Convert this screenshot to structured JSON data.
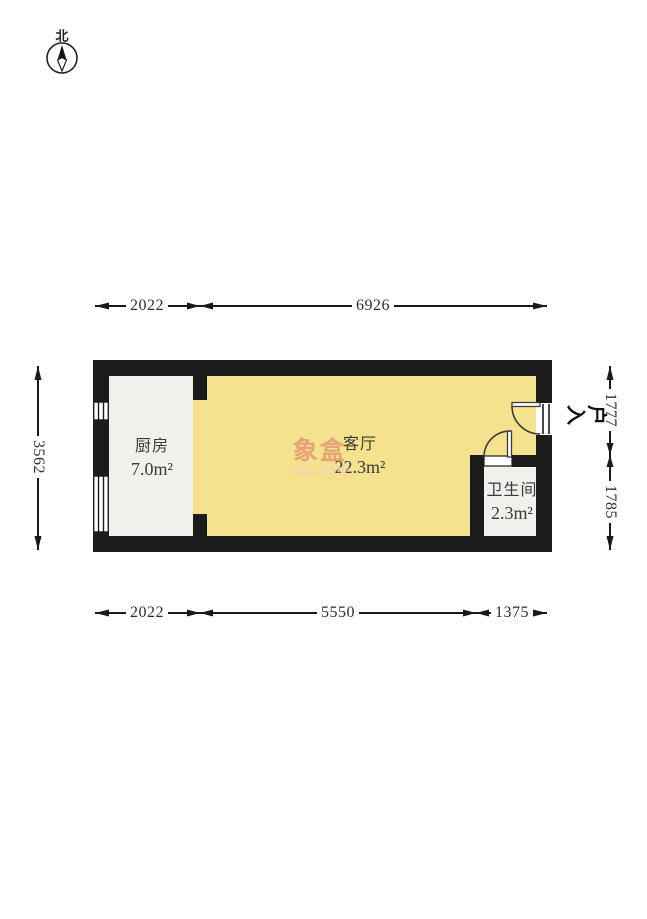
{
  "compass": {
    "north_label": "北"
  },
  "watermark": {
    "brand": "象盒",
    "site": "XHJ.COM"
  },
  "rooms": [
    {
      "name": "厨房",
      "area": "7.0m²"
    },
    {
      "name": "客厅",
      "area": "22.3m²"
    },
    {
      "name": "卫生间",
      "area": "2.3m²"
    }
  ],
  "entry": {
    "label": "入户",
    "chars": [
      "入",
      "户"
    ]
  },
  "dimensions": {
    "top": [
      "2022",
      "6926"
    ],
    "bottom": [
      "2022",
      "5550",
      "1375"
    ],
    "left": [
      "3562"
    ],
    "right": [
      "1777",
      "1785"
    ]
  },
  "colors": {
    "wall": "#1c1c1c",
    "living_room": "#f5e28e",
    "service_room": "#f1f0ec",
    "dim_line": "#1a1a1a",
    "door_line": "#3a3a3a"
  }
}
